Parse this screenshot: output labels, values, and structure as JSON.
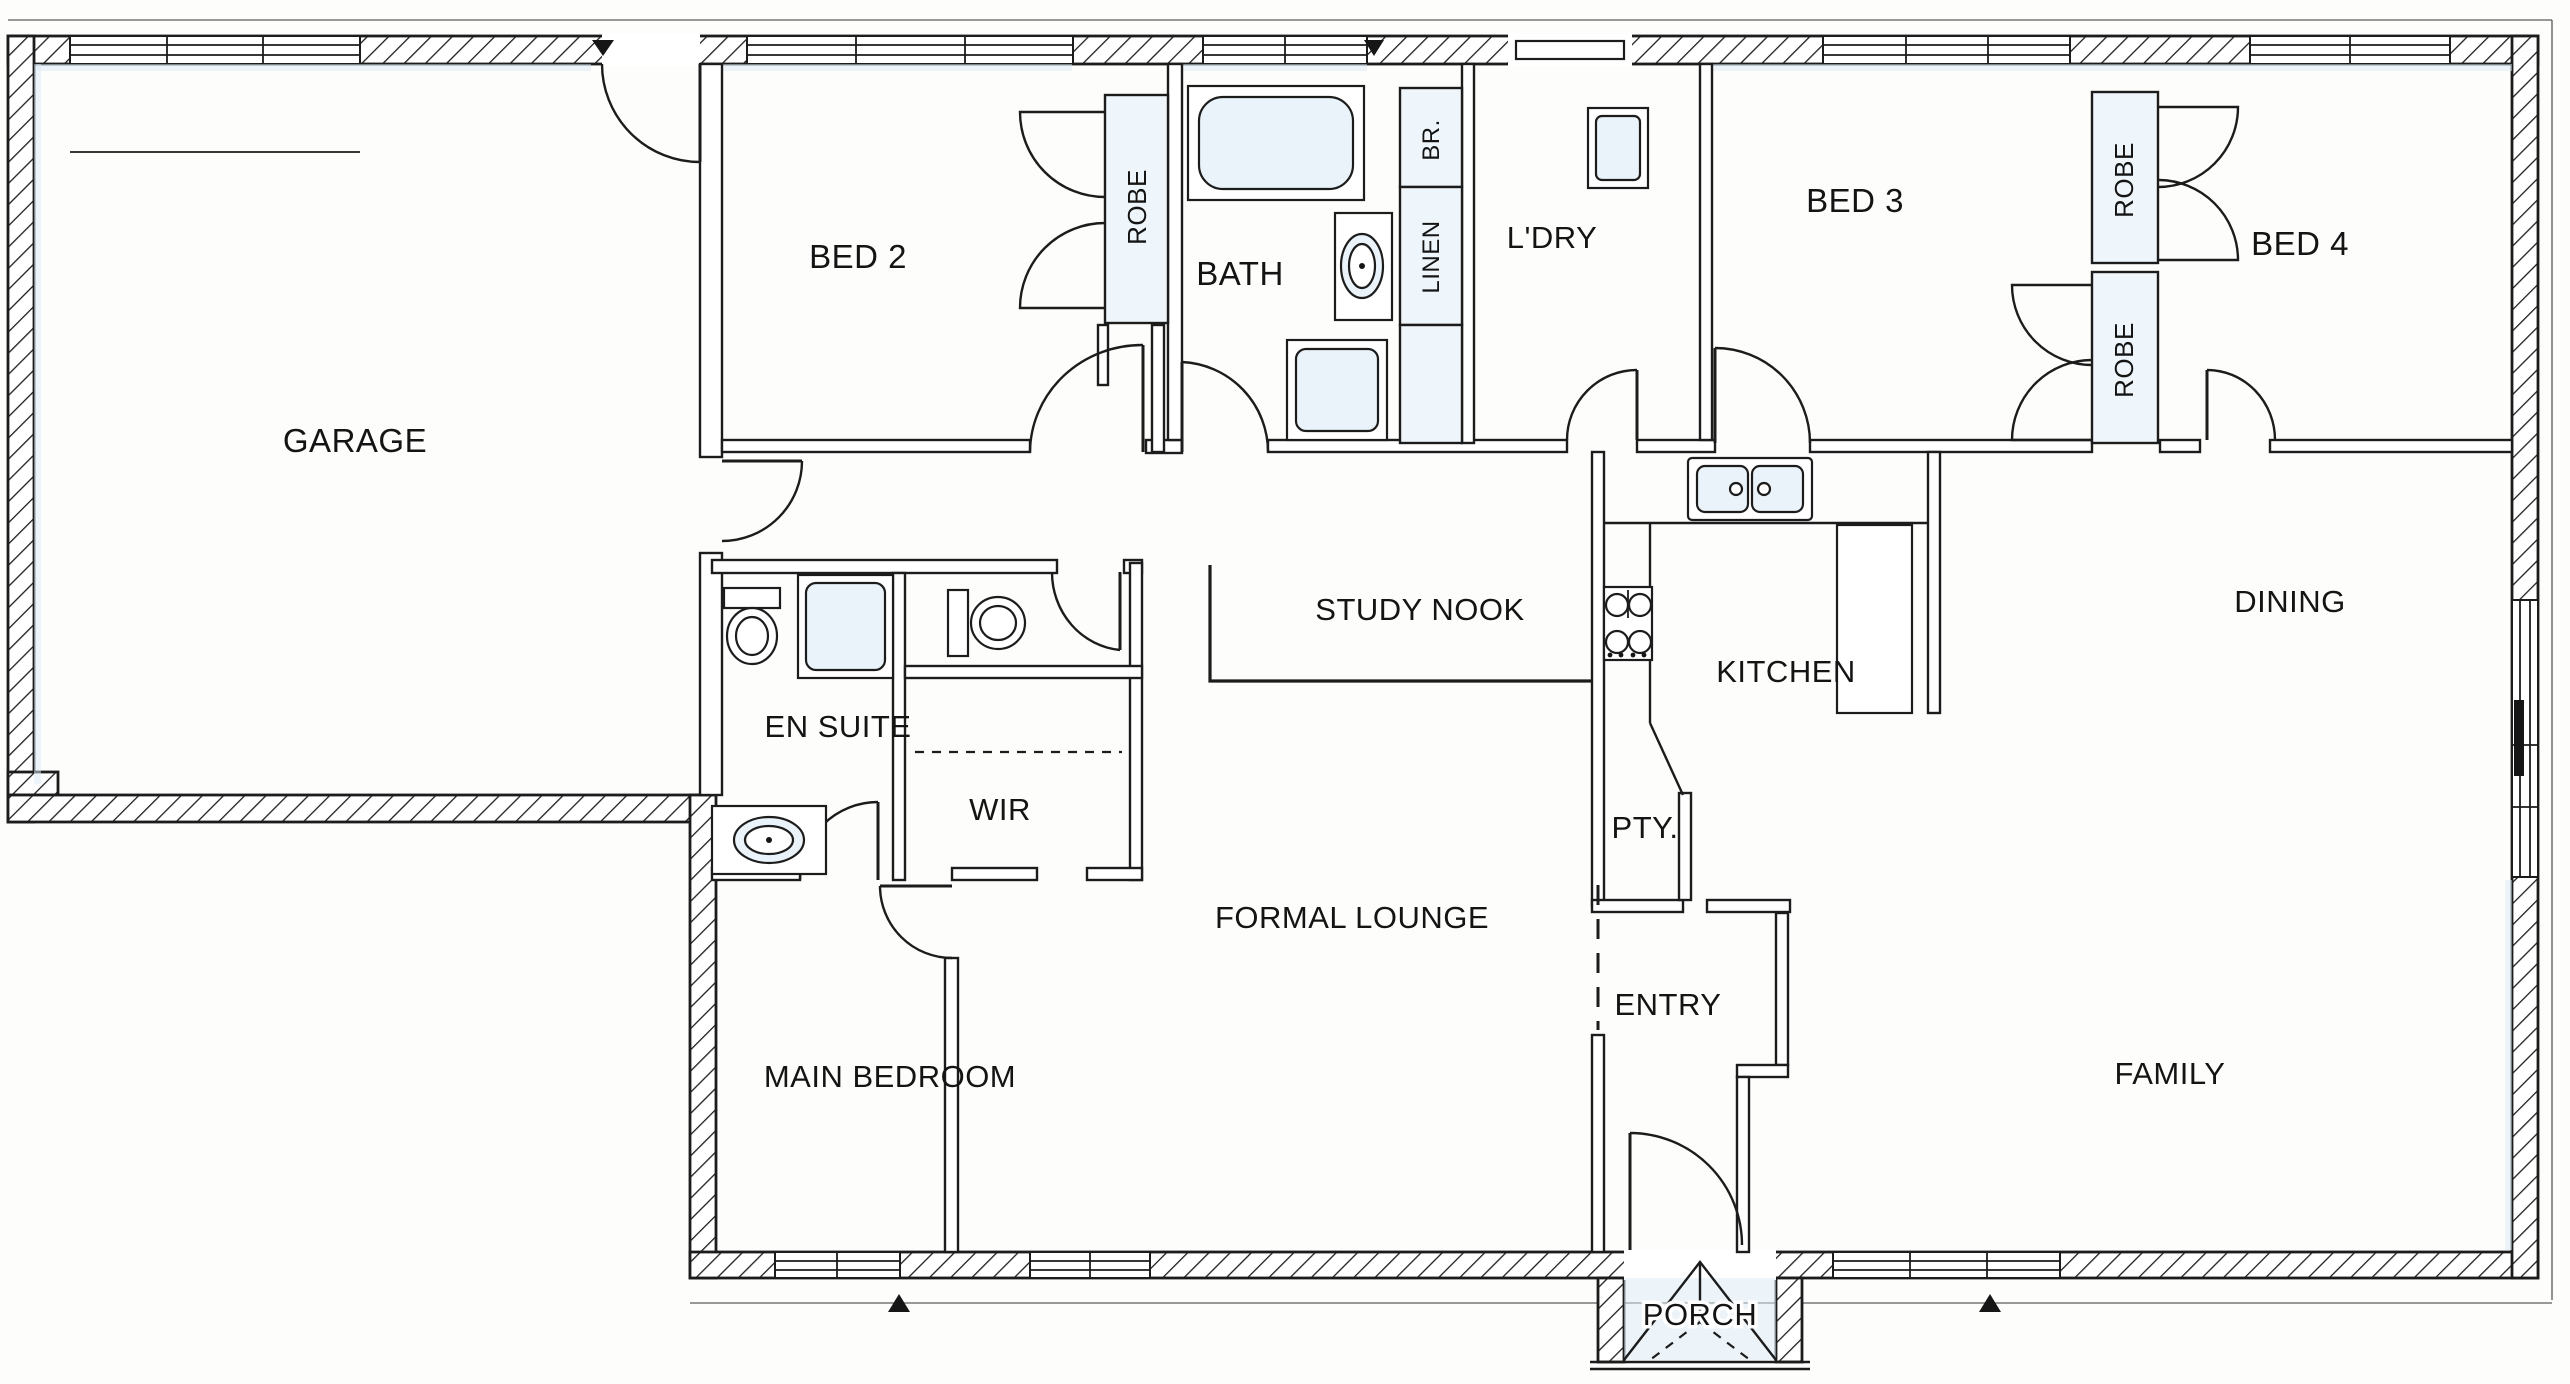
{
  "plan": {
    "title": "Single-storey house floor plan",
    "rooms": [
      {
        "label": "GARAGE"
      },
      {
        "label": "BED 2"
      },
      {
        "label": "ROBE"
      },
      {
        "label": "BATH"
      },
      {
        "label": "BR."
      },
      {
        "label": "LINEN"
      },
      {
        "label": "L'DRY"
      },
      {
        "label": "BED 3"
      },
      {
        "label": "ROBE"
      },
      {
        "label": "BED 4"
      },
      {
        "label": "ROBE"
      },
      {
        "label": "STUDY NOOK"
      },
      {
        "label": "KITCHEN"
      },
      {
        "label": "DINING"
      },
      {
        "label": "EN SUITE"
      },
      {
        "label": "WIR"
      },
      {
        "label": "PTY."
      },
      {
        "label": "FORMAL LOUNGE"
      },
      {
        "label": "ENTRY"
      },
      {
        "label": "MAIN BEDROOM"
      },
      {
        "label": "FAMILY"
      },
      {
        "label": "PORCH"
      }
    ],
    "fixtures": [
      "bathtub",
      "shower",
      "toilet",
      "vanity-basin",
      "double-kitchen-sink",
      "cooktop",
      "laundry-trough",
      "wardrobe-doors",
      "study-bench",
      "kitchen-peninsula"
    ],
    "colors": {
      "ink": "#1c1c1c",
      "paper": "#fdfdfc",
      "scan_tint": "#dcecf6"
    }
  }
}
